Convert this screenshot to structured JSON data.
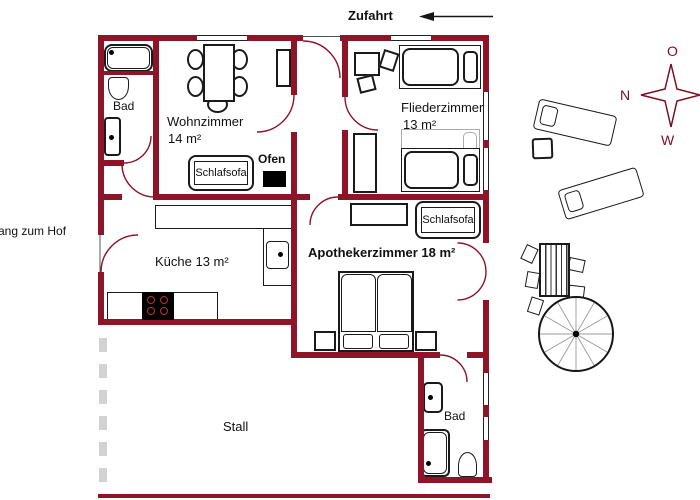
{
  "labels": {
    "zufahrt": "Zufahrt",
    "stall": "Stall",
    "hof_entrance": "ang zum Hof"
  },
  "rooms": {
    "bad_top": "Bad",
    "wohnzimmer_name": "Wohnzimmer",
    "wohnzimmer_area": "14 m²",
    "fliederzimmer_name": "Fliederzimmer",
    "fliederzimmer_area": "13 m²",
    "kueche": "Küche 13 m²",
    "apothekerzimmer": "Apothekerzimmer 18 m²",
    "bad_bottom": "Bad"
  },
  "furniture": {
    "schlafsofa_wohnzimmer": "Schlafsofa",
    "schlafsofa_apothekerzimmer": "Schlafsofa",
    "ofen": "Ofen"
  },
  "compass": {
    "top": "O",
    "left": "N",
    "bottom": "W"
  },
  "colors": {
    "wall": "#8e1428",
    "door_arc": "#8e1428",
    "outline": "#1a1a1a",
    "ghost": "#ababab",
    "dashed_boundary": "#d2d2d2",
    "burner": "#c03030",
    "compass_text": "#7a1020"
  }
}
